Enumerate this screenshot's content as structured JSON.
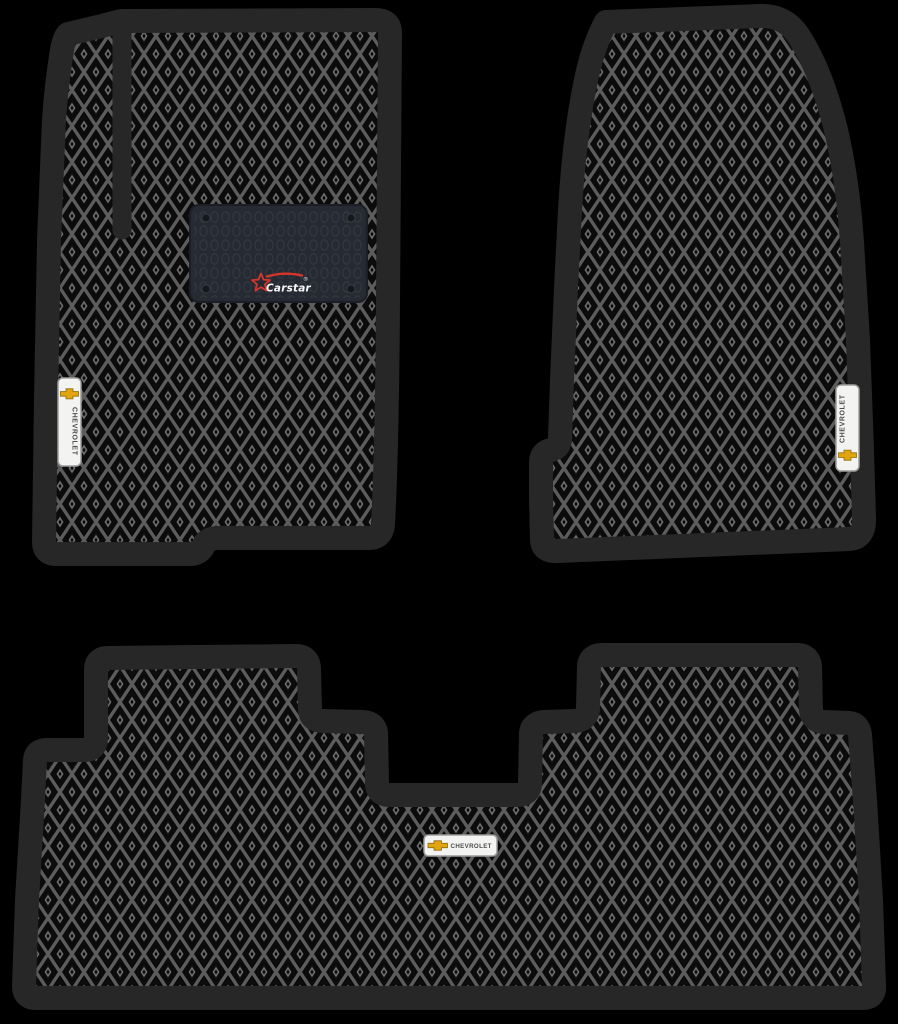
{
  "page": {
    "title": "Chevrolet EVA car floor mats set",
    "background_color": "#000000",
    "mat_count": "3"
  },
  "pattern": {
    "type": "rhombus-eva",
    "lattice_color": "#5c5c5c",
    "cell_color": "#0b0b0b",
    "dot_color": "#6b6b6b",
    "mat_edge_color": "#272727"
  },
  "brand_patch": {
    "label": "Carstar",
    "registered_mark": "®",
    "patch_color": "#262b33",
    "texture_color": "#343a43",
    "accent_color": "#d6352c",
    "text_color": "#f7f7f7"
  },
  "badge": {
    "make_label": "CHEVROLET",
    "bowtie_color": "#e3a50f",
    "bowtie_edge_color": "#8a6d0a",
    "plate_color": "#f3f3f1",
    "plate_edge_color": "#9e9e9c",
    "text_color": "#4d4d4d"
  },
  "mats": {
    "front_driver": {
      "id": "front-driver-mat"
    },
    "front_passenger": {
      "id": "front-passenger-mat"
    },
    "rear": {
      "id": "rear-mat"
    }
  }
}
